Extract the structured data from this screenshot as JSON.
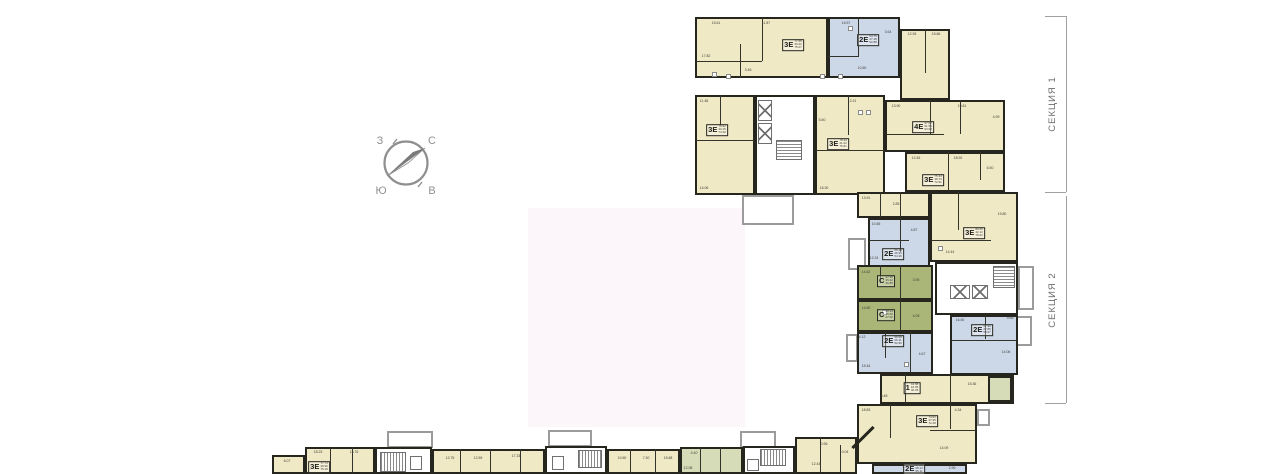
{
  "compass": {
    "nw": "З",
    "ne": "С",
    "sw": "Ю",
    "se": "В"
  },
  "sections": [
    {
      "label": "СЕКЦИЯ 1",
      "y1": 16,
      "y2": 192
    },
    {
      "label": "СЕКЦИЯ 2",
      "y1": 196,
      "y2": 403
    }
  ],
  "palette": {
    "wall": "#26261e",
    "cream": "#f0e9c5",
    "blue": "#ccd7e8",
    "green": "#a9b677",
    "lightgreen": "#d6dcb8",
    "white": "#ffffff",
    "gray": "#9b9b9b",
    "pink": "#fcf5fa"
  },
  "floorplan": {
    "overlay": {
      "x": 528,
      "y": 208,
      "w": 217,
      "h": 219,
      "fill": "pink"
    },
    "units": [
      {
        "id": "s1-3e-a",
        "x": 695,
        "y": 17,
        "w": 133,
        "h": 61,
        "fill": "cream",
        "type": "3Е",
        "label": {
          "x": 793,
          "y": 45,
          "areas": [
            "77.66",
            "39.22",
            "75.07"
          ]
        }
      },
      {
        "id": "s1-2e-a",
        "x": 828,
        "y": 17,
        "w": 72,
        "h": 61,
        "fill": "blue",
        "type": "2Е",
        "label": {
          "x": 868,
          "y": 40,
          "areas": [
            "54.75",
            "27.48",
            "52.88"
          ]
        }
      },
      {
        "id": "s1-rooms-a",
        "x": 900,
        "y": 29,
        "w": 50,
        "h": 71,
        "fill": "cream"
      },
      {
        "id": "s1-3e-b",
        "x": 695,
        "y": 95,
        "w": 60,
        "h": 100,
        "fill": "cream",
        "type": "3Е",
        "label": {
          "x": 717,
          "y": 130,
          "areas": [
            "76.92",
            "40.15",
            "74.30"
          ]
        }
      },
      {
        "id": "s1-3e-c",
        "x": 815,
        "y": 95,
        "w": 70,
        "h": 100,
        "fill": "cream",
        "type": "3Е",
        "label": {
          "x": 838,
          "y": 144,
          "areas": [
            "78.34",
            "41.02",
            "75.81"
          ]
        }
      },
      {
        "id": "s1-4e",
        "x": 885,
        "y": 100,
        "w": 120,
        "h": 52,
        "fill": "cream",
        "type": "4Е",
        "label": {
          "x": 923,
          "y": 127,
          "areas": [
            "97.02",
            "51.55",
            "93.08"
          ]
        }
      },
      {
        "id": "s1-3e-d",
        "x": 905,
        "y": 152,
        "w": 100,
        "h": 40,
        "fill": "cream",
        "type": "3Е",
        "label": {
          "x": 933,
          "y": 180,
          "areas": [
            "75.44",
            "38.73",
            "72.91"
          ]
        }
      },
      {
        "id": "s2-rooms",
        "x": 857,
        "y": 192,
        "w": 73,
        "h": 26,
        "fill": "cream"
      },
      {
        "id": "s2-3e-a",
        "x": 930,
        "y": 192,
        "w": 88,
        "h": 70,
        "fill": "cream",
        "type": "3Е",
        "label": {
          "x": 974,
          "y": 233,
          "areas": [
            "80.45",
            "42.12",
            "78.03"
          ]
        }
      },
      {
        "id": "s2-2e-a",
        "x": 868,
        "y": 218,
        "w": 62,
        "h": 55,
        "fill": "blue",
        "type": "2Е",
        "label": {
          "x": 893,
          "y": 254,
          "areas": [
            "56.48",
            "26.93",
            "54.36"
          ]
        }
      },
      {
        "id": "s2-studio-a",
        "x": 857,
        "y": 265,
        "w": 76,
        "h": 35,
        "fill": "green",
        "type": "С",
        "label": {
          "x": 886,
          "y": 281,
          "areas": [
            "27.95",
            "15.42",
            "26.85"
          ]
        }
      },
      {
        "id": "s2-studio-b",
        "x": 857,
        "y": 300,
        "w": 76,
        "h": 32,
        "fill": "green",
        "type": "С",
        "label": {
          "x": 886,
          "y": 315,
          "areas": [
            "28.13",
            "15.60",
            "27.02"
          ]
        }
      },
      {
        "id": "s2-2e-b",
        "x": 950,
        "y": 315,
        "w": 68,
        "h": 60,
        "fill": "blue",
        "type": "2Е",
        "label": {
          "x": 982,
          "y": 330,
          "areas": [
            "57.90",
            "27.86",
            "55.67"
          ]
        }
      },
      {
        "id": "s2-2e-c",
        "x": 857,
        "y": 332,
        "w": 76,
        "h": 42,
        "fill": "blue",
        "type": "2Е",
        "label": {
          "x": 893,
          "y": 341,
          "areas": [
            "55.08",
            "26.11",
            "52.96"
          ]
        }
      },
      {
        "id": "s2-1k",
        "x": 880,
        "y": 374,
        "w": 134,
        "h": 30,
        "fill": "cream",
        "type": "1",
        "label": {
          "x": 912,
          "y": 388,
          "areas": [
            "41.88",
            "16.05",
            "40.05"
          ]
        }
      },
      {
        "id": "s2-green-room",
        "x": 988,
        "y": 376,
        "w": 24,
        "h": 26,
        "fill": "lightgreen"
      },
      {
        "id": "s2-3e-b",
        "x": 857,
        "y": 404,
        "w": 120,
        "h": 60,
        "fill": "cream",
        "type": "3Е",
        "label": {
          "x": 927,
          "y": 421,
          "areas": [
            "74.63",
            "37.95",
            "72.28"
          ]
        }
      },
      {
        "id": "s2-2e-d",
        "x": 872,
        "y": 464,
        "w": 95,
        "h": 10,
        "fill": "blue",
        "type": "2Е",
        "label": {
          "x": 914,
          "y": 469,
          "areas": [
            "57.09",
            "28.14",
            "55.11"
          ]
        }
      },
      {
        "id": "s3-room-a",
        "x": 272,
        "y": 455,
        "w": 33,
        "h": 19,
        "fill": "cream"
      },
      {
        "id": "s3-3e",
        "x": 305,
        "y": 447,
        "w": 70,
        "h": 27,
        "fill": "cream",
        "type": "3Е",
        "label": {
          "x": 319,
          "y": 467,
          "areas": [
            "77.73",
            "39.90",
            "75.18"
          ]
        }
      },
      {
        "id": "s3-rooms-b",
        "x": 432,
        "y": 449,
        "w": 113,
        "h": 25,
        "fill": "cream"
      },
      {
        "id": "s3-rooms-c",
        "x": 607,
        "y": 449,
        "w": 73,
        "h": 25,
        "fill": "cream"
      },
      {
        "id": "s3-green",
        "x": 680,
        "y": 447,
        "w": 63,
        "h": 27,
        "fill": "lightgreen"
      },
      {
        "id": "s3-rooms-d",
        "x": 795,
        "y": 437,
        "w": 62,
        "h": 37,
        "fill": "cream"
      }
    ],
    "balconies": [
      {
        "x": 742,
        "y": 195,
        "w": 52,
        "h": 30
      },
      {
        "x": 848,
        "y": 238,
        "w": 18,
        "h": 32
      },
      {
        "x": 846,
        "y": 334,
        "w": 12,
        "h": 28
      },
      {
        "x": 1018,
        "y": 266,
        "w": 16,
        "h": 44
      },
      {
        "x": 1016,
        "y": 316,
        "w": 16,
        "h": 30
      },
      {
        "x": 977,
        "y": 409,
        "w": 13,
        "h": 17
      },
      {
        "x": 387,
        "y": 431,
        "w": 46,
        "h": 17
      },
      {
        "x": 548,
        "y": 430,
        "w": 44,
        "h": 17
      },
      {
        "x": 740,
        "y": 431,
        "w": 36,
        "h": 17
      }
    ],
    "cores": [
      {
        "x": 755,
        "y": 95,
        "w": 60,
        "h": 100,
        "elevators": [
          {
            "x": 758,
            "y": 100,
            "w": 14,
            "h": 21
          },
          {
            "x": 758,
            "y": 123,
            "w": 14,
            "h": 21
          }
        ],
        "stairs": [
          {
            "x": 776,
            "y": 140,
            "w": 26,
            "h": 20,
            "dir": "h"
          }
        ],
        "boxes": []
      },
      {
        "x": 935,
        "y": 262,
        "w": 83,
        "h": 53,
        "elevators": [
          {
            "x": 950,
            "y": 285,
            "w": 20,
            "h": 14
          },
          {
            "x": 972,
            "y": 285,
            "w": 16,
            "h": 14
          }
        ],
        "stairs": [
          {
            "x": 993,
            "y": 266,
            "w": 22,
            "h": 22,
            "dir": "h"
          }
        ],
        "boxes": []
      },
      {
        "x": 375,
        "y": 447,
        "w": 57,
        "h": 27,
        "elevators": [],
        "stairs": [
          {
            "x": 380,
            "y": 452,
            "w": 26,
            "h": 20,
            "dir": "v"
          }
        ],
        "boxes": [
          {
            "x": 410,
            "y": 456,
            "w": 12,
            "h": 14
          }
        ]
      },
      {
        "x": 545,
        "y": 446,
        "w": 62,
        "h": 28,
        "elevators": [],
        "stairs": [
          {
            "x": 578,
            "y": 450,
            "w": 24,
            "h": 18,
            "dir": "v"
          }
        ],
        "boxes": [
          {
            "x": 552,
            "y": 456,
            "w": 12,
            "h": 14
          }
        ]
      },
      {
        "x": 743,
        "y": 446,
        "w": 52,
        "h": 28,
        "elevators": [],
        "stairs": [
          {
            "x": 760,
            "y": 449,
            "w": 26,
            "h": 17,
            "dir": "v"
          }
        ],
        "boxes": [
          {
            "x": 747,
            "y": 459,
            "w": 12,
            "h": 12
          }
        ]
      }
    ],
    "dividers": [
      [
        762,
        17,
        1,
        44
      ],
      [
        740,
        44,
        1,
        34
      ],
      [
        696,
        61,
        66,
        1
      ],
      [
        858,
        17,
        1,
        40
      ],
      [
        828,
        56,
        30,
        1
      ],
      [
        925,
        29,
        1,
        44
      ],
      [
        696,
        140,
        58,
        1
      ],
      [
        720,
        95,
        1,
        30
      ],
      [
        816,
        150,
        68,
        1
      ],
      [
        848,
        95,
        1,
        40
      ],
      [
        930,
        100,
        1,
        34
      ],
      [
        960,
        100,
        1,
        34
      ],
      [
        886,
        134,
        58,
        1
      ],
      [
        948,
        152,
        1,
        39
      ],
      [
        980,
        152,
        1,
        28
      ],
      [
        880,
        192,
        1,
        25
      ],
      [
        900,
        192,
        1,
        25
      ],
      [
        958,
        192,
        1,
        38
      ],
      [
        931,
        240,
        60,
        1
      ],
      [
        869,
        240,
        40,
        1
      ],
      [
        900,
        218,
        1,
        34
      ],
      [
        900,
        265,
        1,
        34
      ],
      [
        880,
        265,
        1,
        18
      ],
      [
        900,
        300,
        1,
        31
      ],
      [
        985,
        315,
        1,
        24
      ],
      [
        951,
        340,
        66,
        1
      ],
      [
        885,
        332,
        1,
        26
      ],
      [
        910,
        332,
        1,
        41
      ],
      [
        905,
        374,
        1,
        29
      ],
      [
        950,
        374,
        1,
        29
      ],
      [
        890,
        404,
        1,
        34
      ],
      [
        930,
        430,
        46,
        1
      ],
      [
        950,
        404,
        1,
        25
      ],
      [
        330,
        447,
        1,
        26
      ],
      [
        352,
        447,
        1,
        26
      ],
      [
        460,
        449,
        1,
        24
      ],
      [
        490,
        449,
        1,
        24
      ],
      [
        520,
        449,
        1,
        24
      ],
      [
        630,
        449,
        1,
        24
      ],
      [
        655,
        449,
        1,
        24
      ],
      [
        700,
        447,
        1,
        26
      ],
      [
        720,
        447,
        1,
        26
      ],
      [
        820,
        437,
        1,
        36
      ],
      [
        840,
        445,
        1,
        28
      ]
    ],
    "diagonals": [
      {
        "x": 848,
        "y": 436,
        "len": 30,
        "th": 3
      }
    ],
    "fixtures": [
      [
        712,
        72
      ],
      [
        726,
        74
      ],
      [
        820,
        74
      ],
      [
        838,
        74
      ],
      [
        848,
        26
      ],
      [
        858,
        110
      ],
      [
        866,
        110
      ],
      [
        938,
        246
      ],
      [
        882,
        310
      ],
      [
        904,
        362
      ]
    ],
    "room_numbers": [
      {
        "t": "15.61",
        "x": 716,
        "y": 23
      },
      {
        "t": "11.87",
        "x": 766,
        "y": 23
      },
      {
        "t": "17.82",
        "x": 706,
        "y": 56
      },
      {
        "t": "3.46",
        "x": 748,
        "y": 70
      },
      {
        "t": "16.57",
        "x": 846,
        "y": 23
      },
      {
        "t": "10.60",
        "x": 862,
        "y": 68
      },
      {
        "t": "3.64",
        "x": 888,
        "y": 32
      },
      {
        "t": "12.93",
        "x": 912,
        "y": 34
      },
      {
        "t": "15.66",
        "x": 936,
        "y": 34
      },
      {
        "t": "11.48",
        "x": 704,
        "y": 101
      },
      {
        "t": "14.06",
        "x": 704,
        "y": 188
      },
      {
        "t": "12.21",
        "x": 852,
        "y": 101
      },
      {
        "t": "16.30",
        "x": 824,
        "y": 188
      },
      {
        "t": "5.60",
        "x": 822,
        "y": 120
      },
      {
        "t": "13.90",
        "x": 896,
        "y": 106
      },
      {
        "t": "19.61",
        "x": 962,
        "y": 106
      },
      {
        "t": "4.99",
        "x": 996,
        "y": 117
      },
      {
        "t": "12.45",
        "x": 916,
        "y": 158
      },
      {
        "t": "18.92",
        "x": 958,
        "y": 158
      },
      {
        "t": "6.50",
        "x": 990,
        "y": 168
      },
      {
        "t": "13.91",
        "x": 866,
        "y": 198
      },
      {
        "t": "2.85",
        "x": 896,
        "y": 204
      },
      {
        "t": "19.80",
        "x": 1002,
        "y": 214
      },
      {
        "t": "14.44",
        "x": 950,
        "y": 252
      },
      {
        "t": "10.65",
        "x": 876,
        "y": 224
      },
      {
        "t": "4.87",
        "x": 914,
        "y": 230
      },
      {
        "t": "12.24",
        "x": 874,
        "y": 258
      },
      {
        "t": "14.62",
        "x": 866,
        "y": 272
      },
      {
        "t": "3.95",
        "x": 916,
        "y": 280
      },
      {
        "t": "14.80",
        "x": 866,
        "y": 308
      },
      {
        "t": "4.05",
        "x": 916,
        "y": 316
      },
      {
        "t": "16.50",
        "x": 960,
        "y": 320
      },
      {
        "t": "9.68",
        "x": 1010,
        "y": 318
      },
      {
        "t": "14.06",
        "x": 1006,
        "y": 352
      },
      {
        "t": "4.12",
        "x": 862,
        "y": 337
      },
      {
        "t": "4.67",
        "x": 922,
        "y": 354
      },
      {
        "t": "15.44",
        "x": 866,
        "y": 366
      },
      {
        "t": "15.36",
        "x": 972,
        "y": 384
      },
      {
        "t": "5.48",
        "x": 884,
        "y": 396
      },
      {
        "t": "18.83",
        "x": 866,
        "y": 410
      },
      {
        "t": "4.34",
        "x": 958,
        "y": 410
      },
      {
        "t": "14.09",
        "x": 944,
        "y": 448
      },
      {
        "t": "2.96",
        "x": 952,
        "y": 468
      },
      {
        "t": "6.07",
        "x": 287,
        "y": 461
      },
      {
        "t": "18.23",
        "x": 318,
        "y": 452
      },
      {
        "t": "14.76",
        "x": 354,
        "y": 452
      },
      {
        "t": "12.75",
        "x": 450,
        "y": 458
      },
      {
        "t": "12.59",
        "x": 478,
        "y": 458
      },
      {
        "t": "17.33",
        "x": 516,
        "y": 456
      },
      {
        "t": "10.60",
        "x": 622,
        "y": 458
      },
      {
        "t": "7.30",
        "x": 646,
        "y": 458
      },
      {
        "t": "15.68",
        "x": 668,
        "y": 458
      },
      {
        "t": "4.40",
        "x": 694,
        "y": 453
      },
      {
        "t": "12.08",
        "x": 688,
        "y": 468
      },
      {
        "t": "0.96",
        "x": 824,
        "y": 444
      },
      {
        "t": "12.43",
        "x": 816,
        "y": 464
      },
      {
        "t": "10.04",
        "x": 844,
        "y": 452
      }
    ]
  }
}
